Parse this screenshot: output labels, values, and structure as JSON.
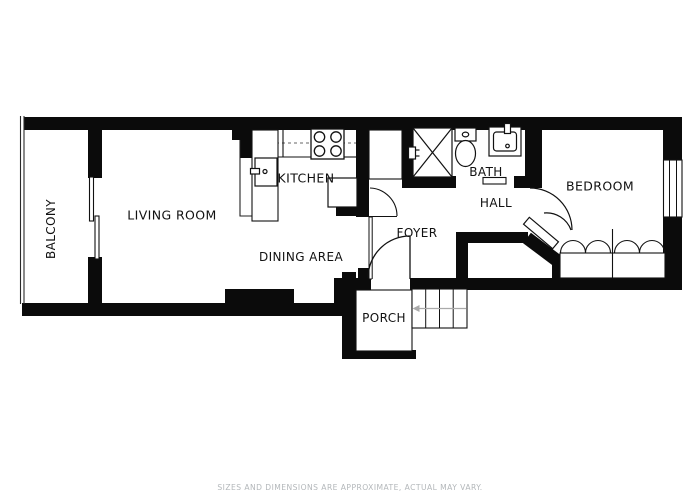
{
  "floor_plan": {
    "rooms": {
      "balcony": {
        "label": "BALCONY"
      },
      "living_room": {
        "label": "LIVING ROOM"
      },
      "kitchen": {
        "label": "KITCHEN"
      },
      "dining_area": {
        "label": "DINING AREA"
      },
      "foyer": {
        "label": "FOYER"
      },
      "porch": {
        "label": "PORCH"
      },
      "bath": {
        "label": "BATH"
      },
      "hall": {
        "label": "HALL"
      },
      "bedroom": {
        "label": "BEDROOM"
      }
    },
    "fixtures": [
      "stove-icon",
      "kitchen-sink-icon",
      "shower-icon",
      "toilet-icon",
      "bathroom-sink-icon",
      "stairs-icon",
      "bifold-closet-doors-icon",
      "sliding-door-icon",
      "window-icon",
      "door-swing-icon",
      "balcony-railing-icon"
    ],
    "disclaimer": "SIZES AND DIMENSIONS ARE APPROXIMATE, ACTUAL MAY VARY.",
    "colors": {
      "walls": "#0b0b0b",
      "background": "#ffffff",
      "label_text": "#111111",
      "disclaimer_text": "#b3b7ba"
    }
  }
}
